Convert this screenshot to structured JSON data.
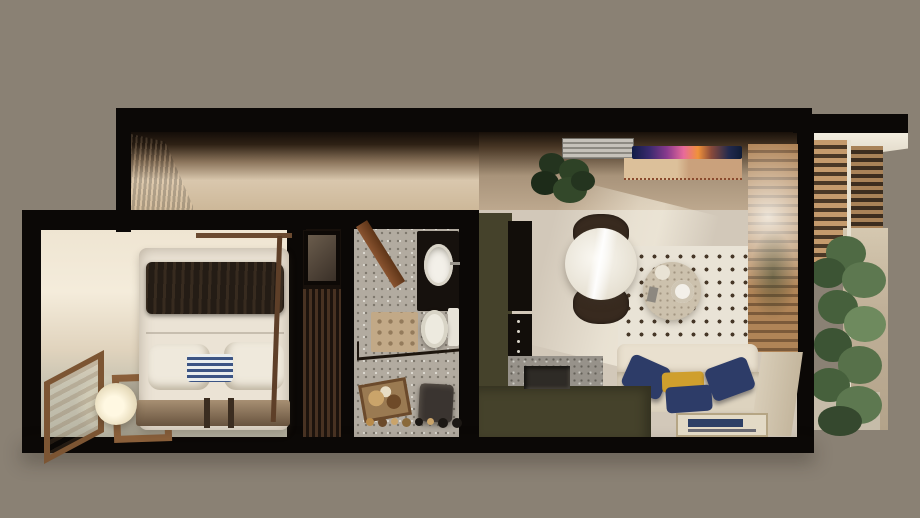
{
  "scene": {
    "kind": "top-down 3d apartment floorplan render",
    "rooms": [
      {
        "name": "bedroom",
        "objects": [
          "double-bed",
          "dark-throw-blanket",
          "white-pillows",
          "blue-striped-pillow",
          "wood-bed-base",
          "canopy-frame",
          "side-window",
          "paper-lantern-lamp",
          "wood-frame-table"
        ]
      },
      {
        "name": "entry-corridor",
        "objects": [
          "wood-cabinet"
        ]
      },
      {
        "name": "closet",
        "objects": [
          "mirror-cabinet",
          "wardrobe"
        ]
      },
      {
        "name": "bathroom",
        "objects": [
          "open-door",
          "black-vanity",
          "oval-sink",
          "toilet",
          "bath-mat",
          "shower-screen",
          "wood-tray",
          "dark-stool",
          "toiletries-row"
        ]
      },
      {
        "name": "living-kitchen",
        "objects": [
          "ac-vent",
          "desk-with-colorful-screen",
          "monstera-plant",
          "round-marble-dining-table",
          "two-dark-chairs",
          "dotted-rug",
          "terrazzo-coffee-table",
          "cream-sofa",
          "navy-cushions",
          "yellow-cushion",
          "floor-artwork",
          "olive-kitchen-cabinets",
          "black-appliance-column",
          "terrazzo-counter-with-sink",
          "olive-island"
        ]
      },
      {
        "name": "balcony",
        "objects": [
          "wood-slat-screens",
          "tan-privacy-wall",
          "tall-green-plant"
        ]
      }
    ]
  },
  "palette": {
    "background": "#8a8174",
    "wall": "#0b0806",
    "corridorWall": "#d9c7ad",
    "cabinetWood": "#6e4526",
    "bedroomWall": "#f2e9d8",
    "bedroomFloor": "#b9b6a5",
    "bedDuvet": "#ebe3d5",
    "bedBlanket": "#241c15",
    "pillowWhite": "#efe9dc",
    "pillowBlue": "#93a7c8",
    "bedBase": "#8a7156",
    "windowWood": "#7c5533",
    "lampGlow": "#fbf3da",
    "closetWood": "#2e2016",
    "bathFloor": "#b2aba0",
    "vanityBlack": "#16110d",
    "sinkWhite": "#f3f0e9",
    "toiletWhite": "#edeadf",
    "matBeige": "#c2a987",
    "trayWood": "#9a7a52",
    "stoolDark": "#3a3430",
    "livingWall": "#bda88e",
    "livingFloor": "#d2c8b9",
    "kitchenGreen": "#45422b",
    "applianceBlack": "#120e0a",
    "counterTerrazzo": "#97928a",
    "diningTableWhite": "#f1ede4",
    "chairBrown": "#382a1f",
    "rugCream": "#e9e3d6",
    "rugDot": "#463728",
    "coffeeTableTerrazzo": "#ccc1ad",
    "sofaCream": "#e9e0cf",
    "sofaSeat": "#ddd3bf",
    "pillowNavy": "#2d3c68",
    "pillowYellow": "#cf9f2d",
    "artNavy": "#2e4066",
    "screenWood": "#ab8158",
    "slatWood": "#c0956a",
    "balconyTan": "#c0b098",
    "plantGreenDark": "#35482e",
    "plantGreenMid": "#5d7850",
    "plantGreenLight": "#6e8a5e",
    "acGray": "#b8b4ac",
    "deskWood": "#d6b894",
    "laptopScreenColors": [
      "#101c46",
      "#8a3a8e",
      "#e86a9a",
      "#f0923a"
    ]
  }
}
